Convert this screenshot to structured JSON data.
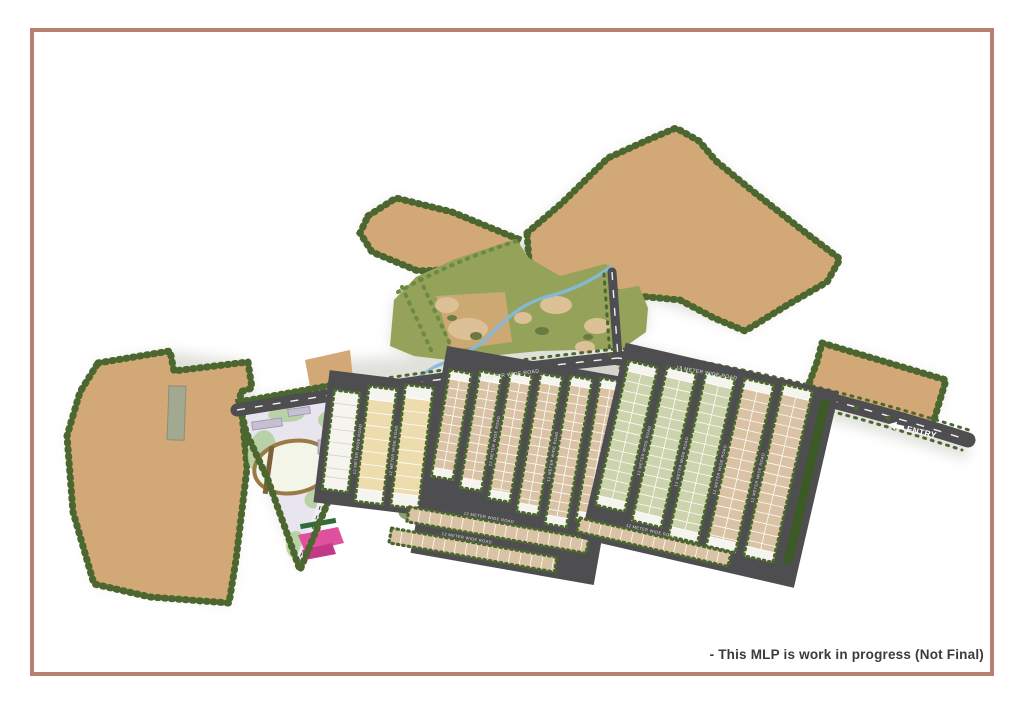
{
  "page": {
    "disclaimer": "- This MLP is work in progress (Not Final)"
  },
  "map": {
    "entry": {
      "label": "ENTRY",
      "arrow_icon": "left-arrow"
    },
    "roads": {
      "main_label": "18 METER WIDE ROAD",
      "secondary_label": "12 METER WIDE ROAD",
      "internal_label": "12 METER WIDE ROAD"
    },
    "colors": {
      "frame": "#b98072",
      "text": "#3b3b3b",
      "tan": "#d2a876",
      "tree": "#4c6630",
      "tree_light": "#6c8a42",
      "park": "#95a25a",
      "sand": "#dcc096",
      "dark_olive": "#6b7a3e",
      "stream": "#85b8da",
      "road": "#4e4e50",
      "plot_tan": "#d9c3a4",
      "plot_sage": "#ccd3ad",
      "plot_white": "#f6f4ef",
      "plot_cream": "#ecdcae",
      "hedge": "#3c5a26",
      "amenity_bg": "#e8e5ee",
      "amenity_green": "#b5cf9f",
      "track_brown": "#9a7a45",
      "building_gray": "#c7c0d2",
      "building_brown": "#7d6138",
      "court_pink": "#e0519d",
      "court_pink_dark": "#c23a85"
    }
  }
}
